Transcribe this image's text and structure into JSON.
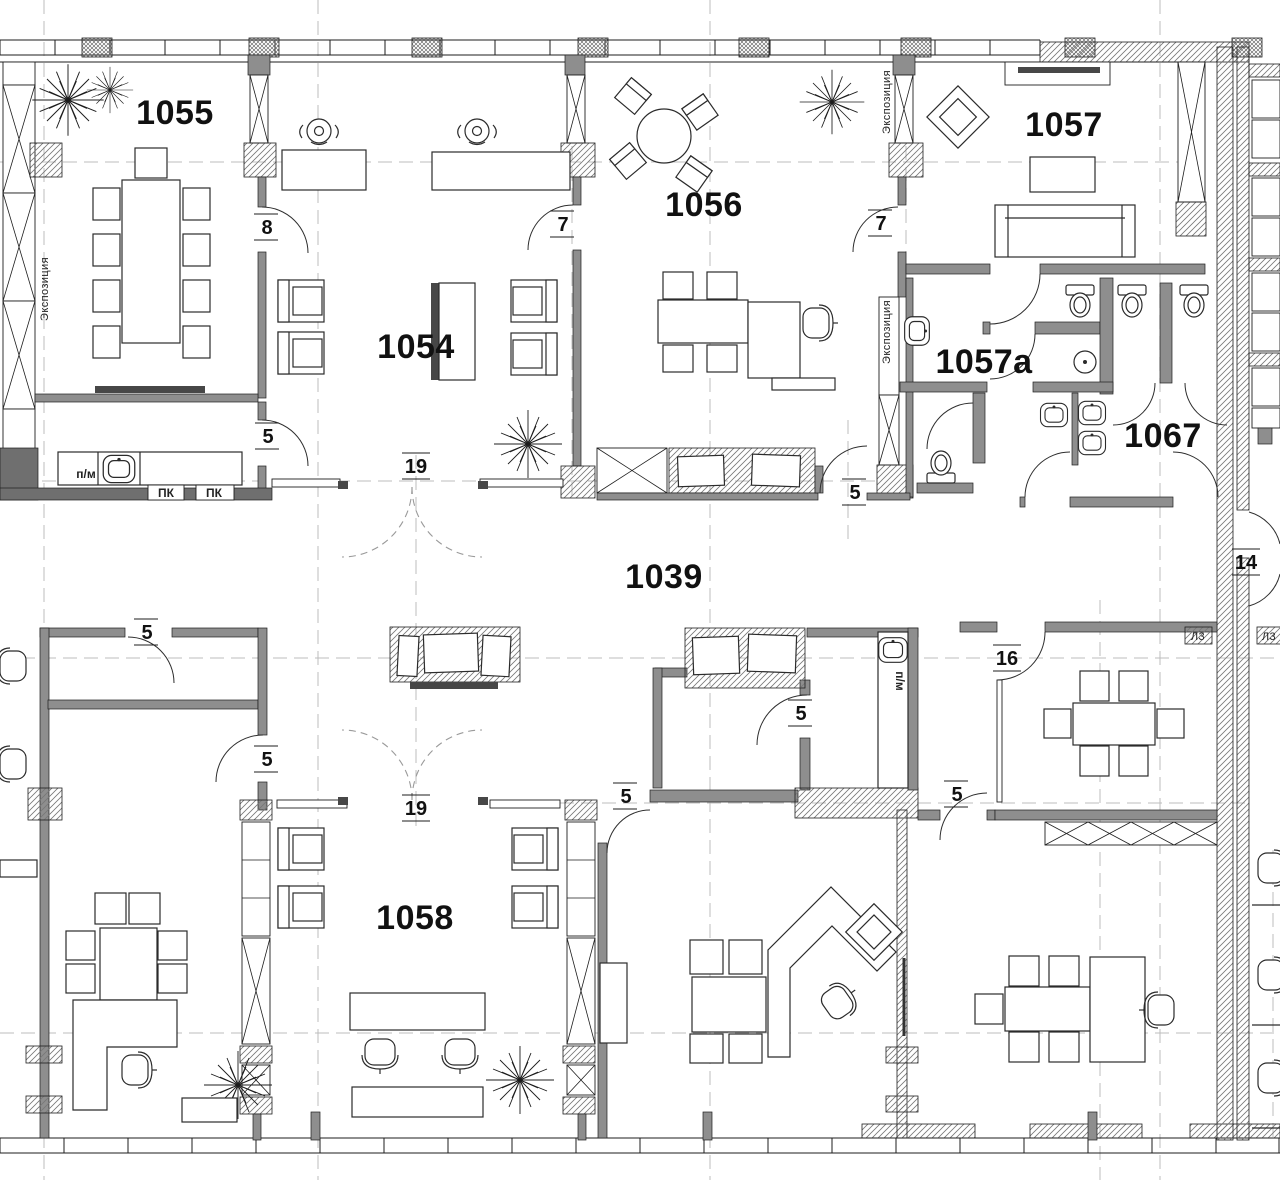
{
  "meta": {
    "drawing": "architectural-floor-plan",
    "width": 1280,
    "height": 1180
  },
  "colors": {
    "background": "#ffffff",
    "wall_gray": "#8e8e8e",
    "wall_dark": "#6f6f6f",
    "line_black": "#1e1e1e",
    "grid_dash_gray": "#bcbcbc",
    "furniture_stroke": "#2b2b2b"
  },
  "rooms": [
    {
      "label": "1055"
    },
    {
      "label": "1054"
    },
    {
      "label": "1056"
    },
    {
      "label": "1057"
    },
    {
      "label": "1057a"
    },
    {
      "label": "1067"
    },
    {
      "label": "1039"
    },
    {
      "label": "1058"
    }
  ],
  "tags": [
    {
      "label": "8"
    },
    {
      "label": "7"
    },
    {
      "label": "7"
    },
    {
      "label": "5"
    },
    {
      "label": "19"
    },
    {
      "label": "5"
    },
    {
      "label": "5"
    },
    {
      "label": "5"
    },
    {
      "label": "19"
    },
    {
      "label": "5"
    },
    {
      "label": "5"
    },
    {
      "label": "5"
    },
    {
      "label": "16"
    },
    {
      "label": "14"
    }
  ],
  "wall_texts": [
    {
      "text": "Экспозиция"
    },
    {
      "text": "Экспозиция"
    },
    {
      "text": "Экспозиция"
    },
    {
      "text": "п/м"
    },
    {
      "text": "п/м"
    },
    {
      "text": "ПК"
    },
    {
      "text": "ПК"
    },
    {
      "text": "Л3"
    },
    {
      "text": "Л3"
    }
  ]
}
